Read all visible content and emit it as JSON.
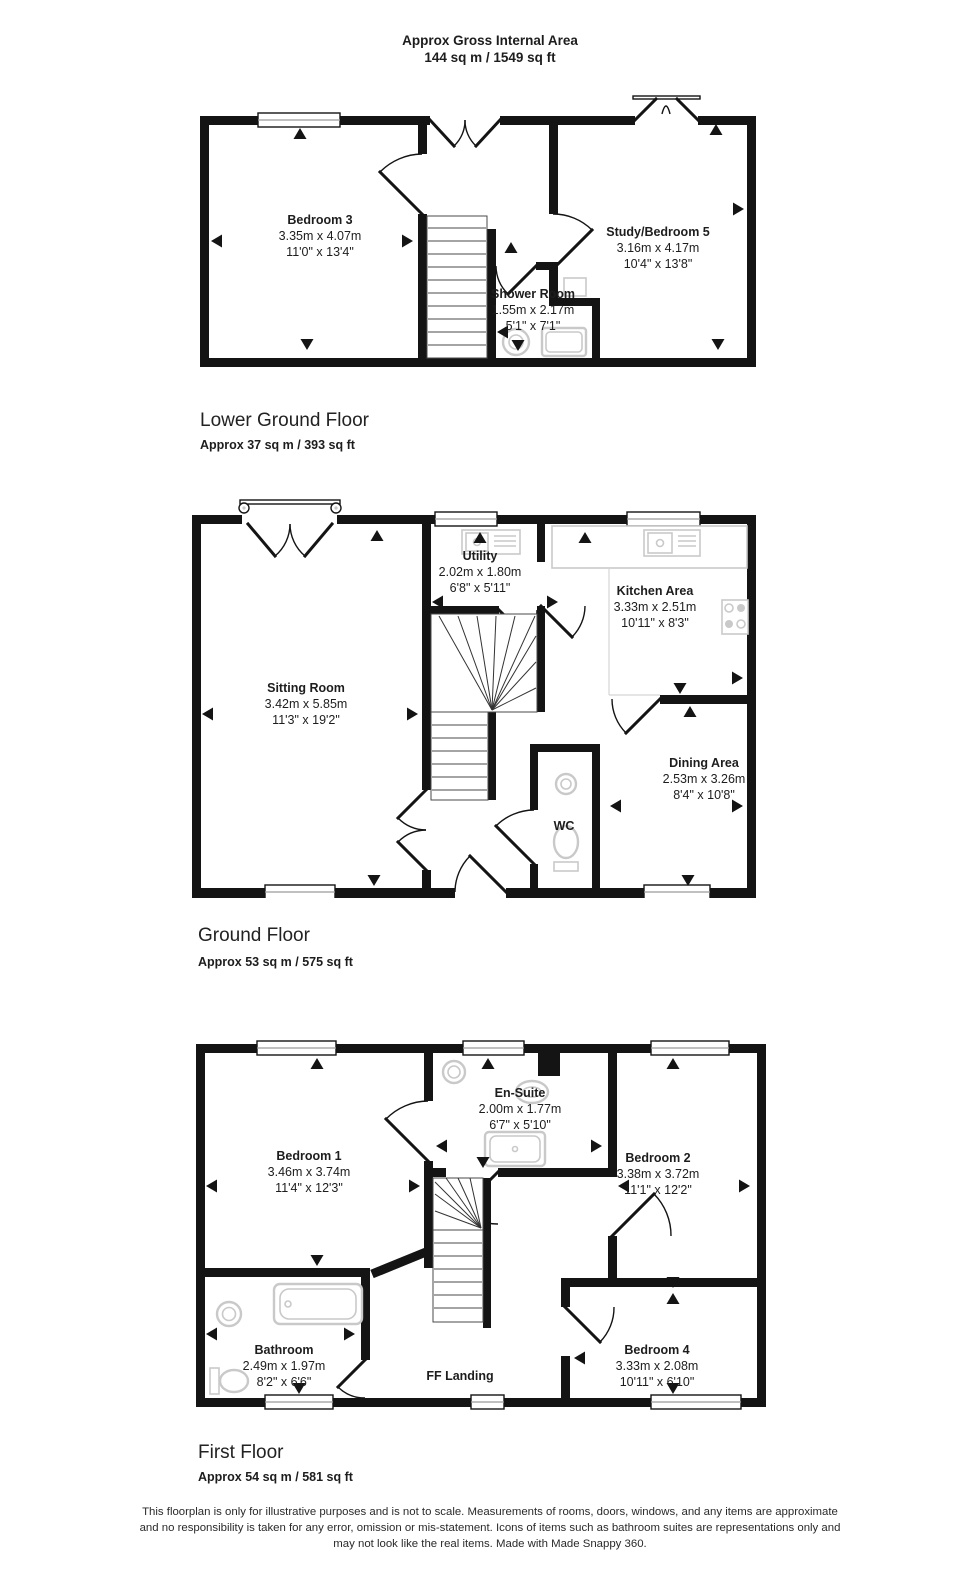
{
  "header": {
    "title": "Approx Gross Internal Area",
    "area": "144 sq m / 1549 sq ft"
  },
  "floors": [
    {
      "title": "Lower Ground Floor",
      "area": "Approx 37 sq m / 393 sq ft",
      "rooms": [
        {
          "name": "Bedroom 3",
          "metric": "3.35m x 4.07m",
          "imperial": "11'0\" x 13'4\""
        },
        {
          "name": "Study/Bedroom 5",
          "metric": "3.16m x 4.17m",
          "imperial": "10'4\" x 13'8\""
        },
        {
          "name": "Shower Room",
          "metric": "1.55m x 2.17m",
          "imperial": "5'1\" x 7'1\""
        }
      ]
    },
    {
      "title": "Ground Floor",
      "area": "Approx 53 sq m / 575 sq ft",
      "rooms": [
        {
          "name": "Utility",
          "metric": "2.02m x 1.80m",
          "imperial": "6'8\" x 5'11\""
        },
        {
          "name": "Kitchen Area",
          "metric": "3.33m x 2.51m",
          "imperial": "10'11\" x 8'3\""
        },
        {
          "name": "Sitting Room",
          "metric": "3.42m x 5.85m",
          "imperial": "11'3\" x 19'2\""
        },
        {
          "name": "Dining Area",
          "metric": "2.53m x 3.26m",
          "imperial": "8'4\" x 10'8\""
        },
        {
          "name": "WC"
        }
      ]
    },
    {
      "title": "First Floor",
      "area": "Approx 54 sq m / 581 sq ft",
      "rooms": [
        {
          "name": "Bedroom 1",
          "metric": "3.46m x 3.74m",
          "imperial": "11'4\" x 12'3\""
        },
        {
          "name": "En-Suite",
          "metric": "2.00m x 1.77m",
          "imperial": "6'7\" x 5'10\""
        },
        {
          "name": "Bedroom 2",
          "metric": "3.38m x 3.72m",
          "imperial": "11'1\" x 12'2\""
        },
        {
          "name": "Bathroom",
          "metric": "2.49m x 1.97m",
          "imperial": "8'2\" x 6'6\""
        },
        {
          "name": "FF Landing"
        },
        {
          "name": "Bedroom 4",
          "metric": "3.33m x 2.08m",
          "imperial": "10'11\" x 6'10\""
        }
      ]
    }
  ],
  "footer": {
    "lines": [
      "This floorplan is only for illustrative purposes and is not to scale. Measurements of rooms, doors, windows, and any items are approximate",
      "and no responsibility is taken for any error, omission or mis-statement. Icons of items such as bathroom suites are representations only and",
      "may not look like the real items. Made with Made Snappy 360."
    ]
  },
  "colors": {
    "wall": "#141414",
    "text": "#1d1d1d",
    "fixture": "#c9c9c9"
  }
}
